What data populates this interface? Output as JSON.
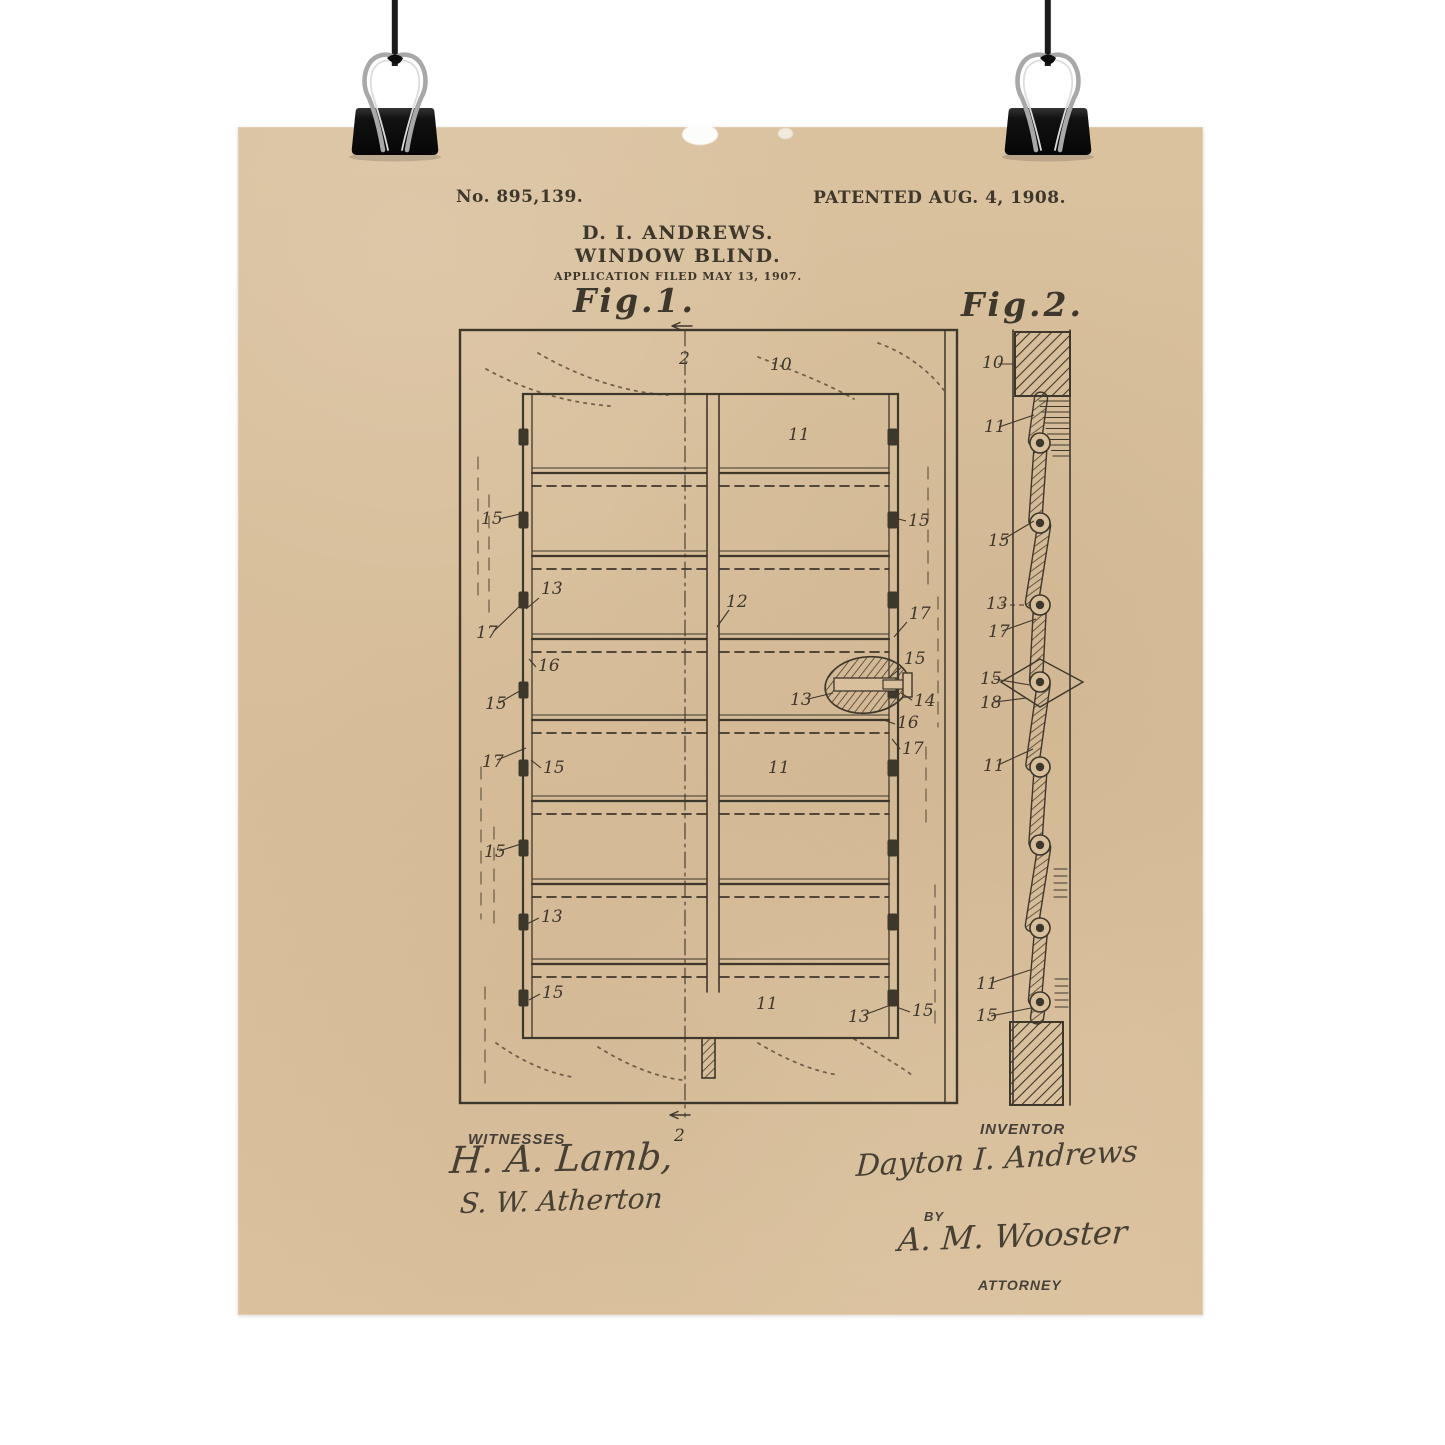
{
  "colors": {
    "paper": "#d9c09d",
    "ink": "#3e372c",
    "cord": "#1b1b1b",
    "clip_body": "#141414",
    "clip_wire": "#a8a8a8",
    "background": "#ffffff"
  },
  "poster": {
    "patent_number": "No. 895,139.",
    "patented_date": "PATENTED AUG. 4, 1908.",
    "inventor_heading": "D. I. ANDREWS.",
    "invention_title": "WINDOW BLIND.",
    "application_line": "APPLICATION FILED MAY 13, 1907.",
    "witnesses": {
      "label": "WITNESSES",
      "names": [
        "H. A. Lamb,",
        "S. W. Atherton"
      ]
    },
    "inventor_block": {
      "label": "INVENTOR",
      "signature": "Dayton I. Andrews",
      "by_label": "BY",
      "attorney_signature": "A. M. Wooster",
      "attorney_label": "ATTORNEY"
    }
  },
  "figures": {
    "fig1": {
      "caption": "Fig.1.",
      "labels": [
        {
          "t": "2",
          "x": 441,
          "y": 237
        },
        {
          "t": "10",
          "x": 532,
          "y": 243
        },
        {
          "t": "11",
          "x": 550,
          "y": 313
        },
        {
          "t": "15",
          "x": 243,
          "y": 397,
          "l": [
            261,
            392,
            282,
            387
          ]
        },
        {
          "t": "15",
          "x": 670,
          "y": 399,
          "l": [
            668,
            394,
            653,
            390
          ]
        },
        {
          "t": "13",
          "x": 303,
          "y": 467,
          "l": [
            301,
            471,
            288,
            482
          ]
        },
        {
          "t": "12",
          "x": 488,
          "y": 480,
          "l": [
            491,
            483,
            479,
            500
          ]
        },
        {
          "t": "17",
          "x": 238,
          "y": 511,
          "l": [
            255,
            505,
            288,
            473
          ]
        },
        {
          "t": "17",
          "x": 671,
          "y": 492,
          "l": [
            669,
            495,
            656,
            510
          ]
        },
        {
          "t": "16",
          "x": 300,
          "y": 544,
          "l": [
            298,
            540,
            291,
            532
          ]
        },
        {
          "t": "15",
          "x": 666,
          "y": 537,
          "l": [
            664,
            540,
            652,
            550
          ]
        },
        {
          "t": "15",
          "x": 247,
          "y": 582,
          "l": [
            261,
            576,
            285,
            562
          ]
        },
        {
          "t": "13",
          "x": 552,
          "y": 578,
          "l": [
            570,
            572,
            595,
            566
          ]
        },
        {
          "t": "14",
          "x": 676,
          "y": 579,
          "l": [
            674,
            573,
            663,
            566
          ]
        },
        {
          "t": "16",
          "x": 659,
          "y": 601,
          "l": [
            657,
            597,
            643,
            592
          ]
        },
        {
          "t": "17",
          "x": 244,
          "y": 640,
          "l": [
            259,
            633,
            288,
            621
          ]
        },
        {
          "t": "15",
          "x": 305,
          "y": 646,
          "l": [
            303,
            641,
            293,
            633
          ]
        },
        {
          "t": "17",
          "x": 664,
          "y": 627,
          "l": [
            662,
            622,
            654,
            612
          ]
        },
        {
          "t": "11",
          "x": 530,
          "y": 646
        },
        {
          "t": "15",
          "x": 246,
          "y": 730,
          "l": [
            261,
            724,
            283,
            717
          ]
        },
        {
          "t": "13",
          "x": 303,
          "y": 795,
          "l": [
            301,
            791,
            289,
            797
          ]
        },
        {
          "t": "15",
          "x": 304,
          "y": 871,
          "l": [
            302,
            867,
            291,
            873
          ]
        },
        {
          "t": "11",
          "x": 518,
          "y": 882
        },
        {
          "t": "13",
          "x": 610,
          "y": 895,
          "l": [
            626,
            888,
            650,
            879
          ]
        },
        {
          "t": "15",
          "x": 674,
          "y": 889,
          "l": [
            672,
            885,
            661,
            881
          ]
        },
        {
          "t": "2",
          "x": 436,
          "y": 1014
        }
      ]
    },
    "fig2": {
      "caption": "Fig.2.",
      "labels": [
        {
          "t": "10",
          "x": 744,
          "y": 241,
          "l": [
            760,
            237,
            778,
            237
          ]
        },
        {
          "t": "11",
          "x": 746,
          "y": 305,
          "l": [
            761,
            300,
            796,
            288
          ]
        },
        {
          "t": "15",
          "x": 750,
          "y": 419,
          "l": [
            764,
            413,
            796,
            394
          ]
        },
        {
          "t": "13",
          "x": 748,
          "y": 482,
          "l": [
            763,
            478,
            793,
            478
          ],
          "dash": true
        },
        {
          "t": "17",
          "x": 750,
          "y": 510,
          "l": [
            764,
            504,
            798,
            492
          ]
        },
        {
          "t": "15",
          "x": 742,
          "y": 557,
          "l": [
            756,
            552,
            792,
            558
          ]
        },
        {
          "t": "18",
          "x": 742,
          "y": 581,
          "l": [
            757,
            575,
            788,
            571
          ]
        },
        {
          "t": "11",
          "x": 745,
          "y": 644,
          "l": [
            760,
            638,
            795,
            622
          ]
        },
        {
          "t": "11",
          "x": 738,
          "y": 862,
          "l": [
            753,
            856,
            792,
            843
          ]
        },
        {
          "t": "15",
          "x": 738,
          "y": 894,
          "l": [
            753,
            889,
            793,
            881
          ]
        }
      ]
    }
  }
}
